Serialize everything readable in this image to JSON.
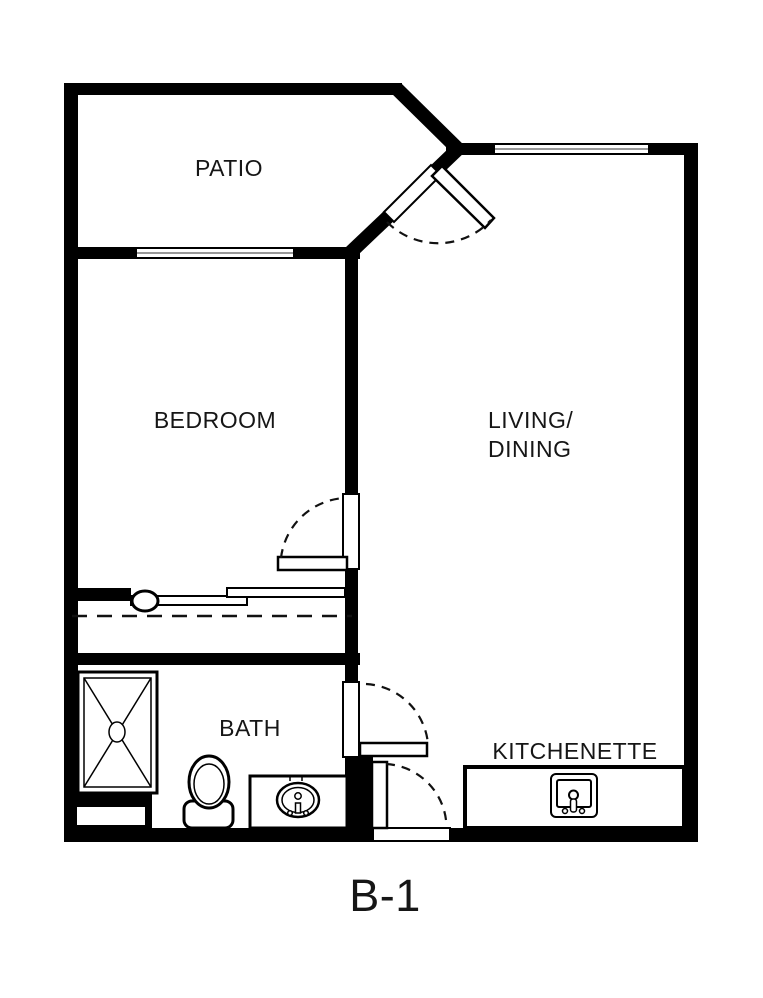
{
  "floor_plan": {
    "unit_label": "B-1",
    "rooms": [
      {
        "id": "patio",
        "label": "PATIO"
      },
      {
        "id": "bedroom",
        "label": "BEDROOM"
      },
      {
        "id": "living_dining",
        "label_line1": "LIVING/",
        "label_line2": "DINING"
      },
      {
        "id": "bath",
        "label": "BATH"
      },
      {
        "id": "kitchenette",
        "label": "KITCHENETTE"
      }
    ],
    "fixtures": [
      "shower",
      "toilet",
      "bath-sink-vanity",
      "kitchenette-sink",
      "closet-sliding-doors",
      "closet-rod"
    ],
    "features": [
      "patio-window",
      "living-window",
      "angled-patio-door",
      "bedroom-door",
      "bath-door",
      "entry-door"
    ],
    "colors": {
      "walls": "#000000",
      "background": "#ffffff",
      "window_mid_line": "#999999"
    }
  }
}
